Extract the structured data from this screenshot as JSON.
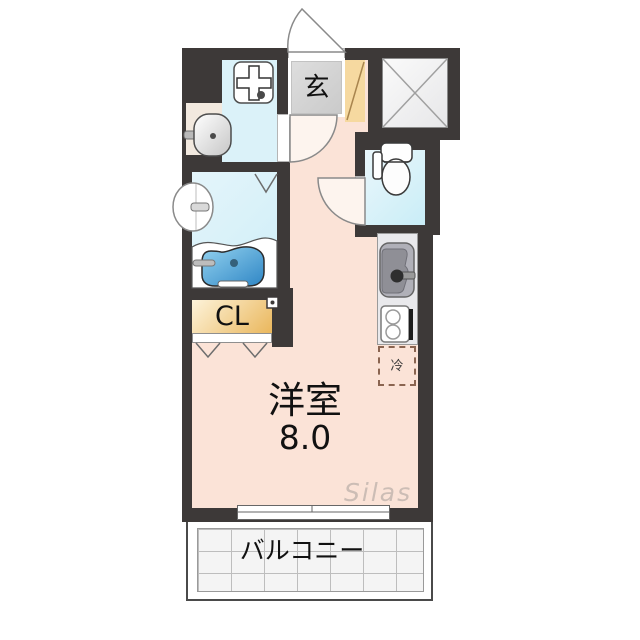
{
  "title": "apartment-floorplan",
  "watermark": "Silas",
  "rooms": {
    "entrance": {
      "label": "玄"
    },
    "closet": {
      "label": "CL"
    },
    "main_room": {
      "label": "洋室",
      "size": "8.0"
    },
    "refrigerator": {
      "label": "冷"
    },
    "balcony": {
      "label": "バルコニー"
    }
  },
  "icons": {
    "elevator": "x-cross-shaft",
    "washing_machine_pan": "plus-cross-pan",
    "washbasin": "oval-basin-with-faucet",
    "bath_round_fixture": "round-wall-basin",
    "bathtub": "blue-tub",
    "toilet": "tank-and-bowl",
    "kitchen_sink": "sink-with-faucet",
    "stove": "two-burner-stove",
    "sliding_window": "double-pane-window",
    "door_swings": "quarter-circle-arcs",
    "folding_door_marks": "v-chevrons"
  },
  "colors": {
    "wall": "#3d3938",
    "floor": "#fbe3d7",
    "water": "#dbf2f9",
    "toilet-water": "#c9edf7",
    "genkan": "#d6d6d6",
    "tan": "#f6d9a0",
    "alcove": "#f2e9df",
    "closet-light": "#fdf3da",
    "closet-dark": "#eab75c",
    "counter": "#e9e9ec",
    "tub-light": "#93d2ef",
    "tub-dark": "#2f86c5",
    "grid": "#bdbdbd",
    "watermark": "#b3a9a4"
  }
}
